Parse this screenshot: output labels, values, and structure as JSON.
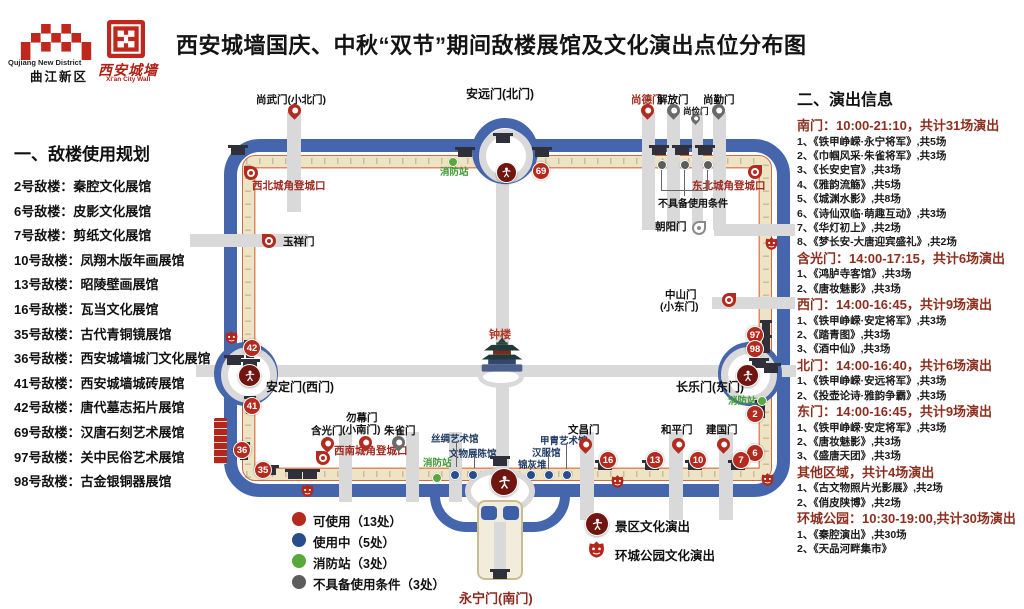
{
  "header": {
    "title": "西安城墙国庆、中秋“双节”期间敌楼展馆及文化演出点位分布图",
    "logo_qujiang": {
      "name_en": "Qujiang New District",
      "name_zh": "曲江新区"
    },
    "logo_wall": {
      "name_zh": "西安城墙",
      "name_en": "Xi'an City Wall"
    }
  },
  "left_panel": {
    "heading": "一、敌楼使用规划",
    "items": [
      "2号敌楼：秦腔文化展馆",
      "6号敌楼：皮影文化展馆",
      "7号敌楼：剪纸文化展馆",
      "10号敌楼：凤翔木版年画展馆",
      "13号敌楼：昭陵壁画展馆",
      "16号敌楼：瓦当文化展馆",
      "35号敌楼：古代青铜镜展馆",
      "36号敌楼：西安城墙城门文化展馆",
      "41号敌楼：西安城墙城砖展馆",
      "42号敌楼：唐代墓志拓片展馆",
      "69号敌楼：汉唐石刻艺术展馆",
      "97号敌楼：关中民俗艺术展馆",
      "98号敌楼：古金银铜器展馆"
    ]
  },
  "right_panel": {
    "heading": "二、演出信息",
    "sections": [
      {
        "header": "南门：10:00-21:10，共计31场演出",
        "items": [
          "1、《铁甲峥嵘·永宁将军》,共5场",
          "2、《巾帼风采·朱雀将军》,共3场",
          "3、《长安史官》,共3场",
          "4、《雅韵流觞》,共5场",
          "5、《城渊水影》,共8场",
          "6、《诗仙双临·萌趣互动》,共3场",
          "7、《华灯初上》,共2场",
          "8、《梦长安-大唐迎宾盛礼》,共2场"
        ]
      },
      {
        "header": "含光门：14:00-17:15，共计6场演出",
        "items": [
          "1、《鸿胪寺客馆》,共3场",
          "2、《唐妆魅影》,共3场"
        ]
      },
      {
        "header": "西门：14:00-16:45，共计9场演出",
        "items": [
          "1、《铁甲峥嵘·安定将军》,共3场",
          "2、《踏青图》,共3场",
          "3、《酒中仙》,共3场"
        ]
      },
      {
        "header": "北门：14:00-16:40，共计6场演出",
        "items": [
          "1、《铁甲峥嵘·安远将军》,共3场",
          "2、《投壶论诗·雅韵争霸》,共3场"
        ]
      },
      {
        "header": "东门：14:00-16:45，共计9场演出",
        "items": [
          "1、《铁甲峥嵘·安定将军》,共3场",
          "2、《唐妆魅影》,共3场",
          "3、《盛唐天团》,共3场"
        ]
      },
      {
        "header": "其他区域，共计4场演出",
        "items": [
          "1、《古文物照片光影展》,共2场",
          "2、《俏皮陕博》,共2场"
        ]
      },
      {
        "header": "环城公园：10:30-19:00,共计30场演出",
        "items": [
          "1、《秦腔演出》,共30场",
          "2、《天品河畔集市》"
        ]
      }
    ]
  },
  "map": {
    "gates": {
      "north": "安远门(北门)",
      "shangwu": "尚武门(小北门)",
      "shangde": "尚德门",
      "jiefang": "解放门",
      "shangjian": "尚俭门",
      "shangqin": "尚勤门",
      "yuxiang": "玉祥门",
      "west": "安定门(西门)",
      "chaoyang": "朝阳门",
      "zhongshan_l1": "中山门",
      "zhongshan_l2": "(小东门)",
      "east": "长乐门(东门)",
      "hanguang": "含光门",
      "wumu_l1": "勿幕门",
      "wumu_l2": "(小南门)",
      "zhuque": "朱雀门",
      "wenchang": "文昌门",
      "heping": "和平门",
      "jianguo": "建国门",
      "south": "永宁门(南门)"
    },
    "corners": {
      "nw": "西北城角登城口",
      "ne": "东北城角登城口",
      "sw": "西南城角登城口"
    },
    "fire_station": "消防站",
    "unusable_note": "不具备使用条件",
    "bell_tower": "钟楼",
    "venues": [
      "丝绸艺术馆",
      "文物展陈馆",
      "锦灰堆",
      "汉服馆",
      "甲胄艺术馆"
    ],
    "badges": {
      "b2": "2",
      "b6": "6",
      "b7": "7",
      "b10": "10",
      "b13": "13",
      "b16": "16",
      "b35": "35",
      "b36": "36",
      "b41": "41",
      "b42": "42",
      "b69": "69",
      "b97": "97",
      "b98": "98"
    },
    "legend": {
      "usable": "可使用（13处）",
      "in_use": "使用中（5处）",
      "fire": "消防站（3处）",
      "unusable": "不具备使用条件（3处）",
      "scenic": "景区文化演出",
      "park": "环城公园文化演出"
    },
    "colors": {
      "usable": "#b52a1e",
      "in_use": "#274d8d",
      "fire": "#58a83d",
      "unusable": "#5c5c5c",
      "moat": "#4566ad"
    }
  }
}
